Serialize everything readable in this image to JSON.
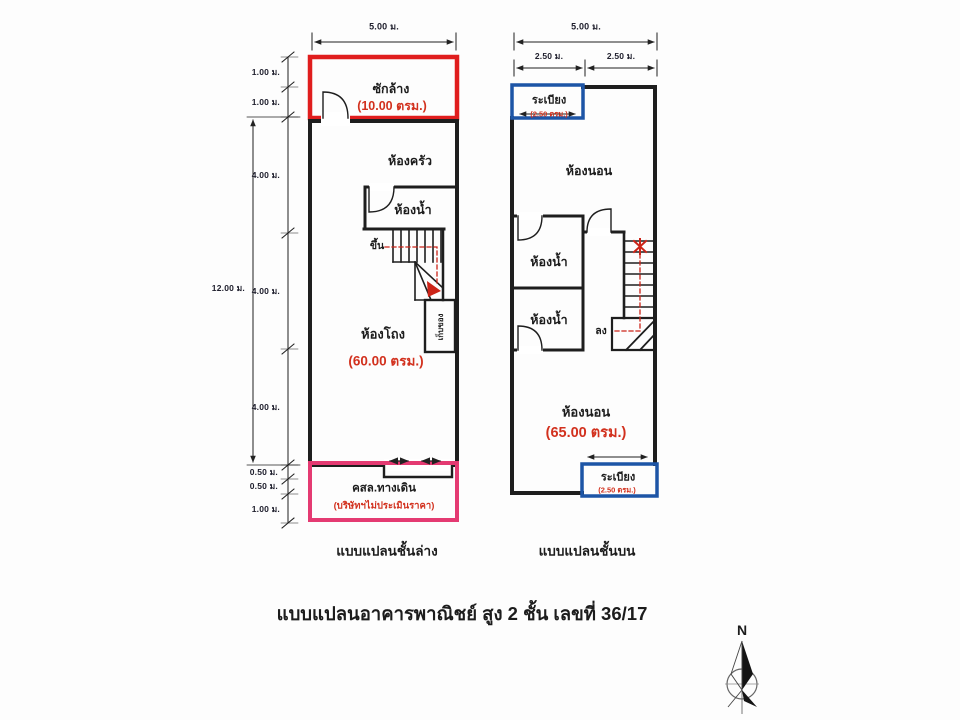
{
  "page_title": "แบบแปลนอาคารพาณิชย์ สูง 2 ชั้น เลขที่ 36/17",
  "compass": {
    "north": "N"
  },
  "colors": {
    "wall": "#1e1e1e",
    "red_outline": "#e01d1d",
    "pink_outline": "#e43a72",
    "blue_outline": "#1d55a6",
    "red_text": "#d2311e"
  },
  "ground": {
    "caption": "แบบแปลนชั้นล่าง",
    "dims": {
      "top": "5.00 ม.",
      "overall": "12.00 ม.",
      "left": [
        "1.00 ม.",
        "1.00 ม.",
        "4.00 ม.",
        "4.00 ม.",
        "4.00 ม.",
        "0.50 ม.",
        "0.50 ม.",
        "1.00 ม."
      ]
    },
    "laundry": {
      "name": "ซักล้าง",
      "area": "(10.00 ตรม.)"
    },
    "kitchen": {
      "name": "ห้องครัว"
    },
    "bathroom": {
      "name": "ห้องน้ำ"
    },
    "stair": {
      "up": "ขึ้น"
    },
    "storage": {
      "name": "เก็บของ"
    },
    "hall": {
      "name": "ห้องโถง",
      "area": "(60.00 ตรม.)"
    },
    "walkway": {
      "name": "คสล.ทางเดิน",
      "note": "(บริษัทฯไม่ประเมินราคา)"
    }
  },
  "upper": {
    "caption": "แบบแปลนชั้นบน",
    "dims": {
      "top": "5.00 ม.",
      "half_left": "2.50 ม.",
      "half_right": "2.50 ม."
    },
    "balcony_top": {
      "name": "ระเบียง",
      "area": "(2.50 ตรม.)"
    },
    "bedroom_top": {
      "name": "ห้องนอน"
    },
    "bathroom_upper": {
      "name": "ห้องน้ำ"
    },
    "bathroom_lower": {
      "name": "ห้องน้ำ"
    },
    "stair": {
      "down": "ลง"
    },
    "bedroom_bottom": {
      "name": "ห้องนอน",
      "area": "(65.00 ตรม.)"
    },
    "balcony_bottom": {
      "name": "ระเบียง",
      "area": "(2.50 ตรม.)"
    }
  }
}
